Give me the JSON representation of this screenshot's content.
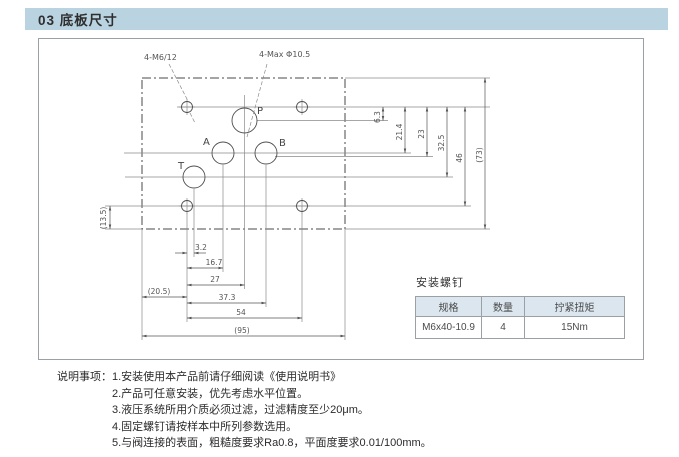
{
  "header": {
    "title": "03 底板尺寸"
  },
  "drawing": {
    "callouts": {
      "screw_holes": "4-M6/12",
      "port_max": "4-Max Φ10.5"
    },
    "ports": {
      "p": "P",
      "a": "A",
      "b": "B",
      "t": "T"
    },
    "dims": {
      "right": [
        "6.3",
        "21.4",
        "23",
        "32.5",
        "46",
        "(73)"
      ],
      "bottom": [
        "3.2",
        "16.7",
        "27",
        "37.3",
        "54",
        "(95)"
      ],
      "left_offset": "(20.5)",
      "side": "(13.5)"
    }
  },
  "screw_table": {
    "title": "安装螺钉",
    "headers": [
      "规格",
      "数量",
      "拧紧扭矩"
    ],
    "row": [
      "M6x40-10.9",
      "4",
      "15Nm"
    ]
  },
  "notes": {
    "label": "说明事项：",
    "items": [
      "1.安装使用本产品前请仔细阅读《使用说明书》",
      "2.产品可任意安装，优先考虑水平位置。",
      "3.液压系统所用介质必须过滤，过滤精度至少20μm。",
      "4.固定螺钉请按样本中所列参数选用。",
      "5.与阀连接的表面，粗糙度要求Ra0.8，平面度要求0.01/100mm。"
    ]
  },
  "colors": {
    "header_bg": "#b9d3e0",
    "table_header_bg": "#dbe6ef",
    "line": "#6a6a6a",
    "border": "#9aa0a6"
  }
}
